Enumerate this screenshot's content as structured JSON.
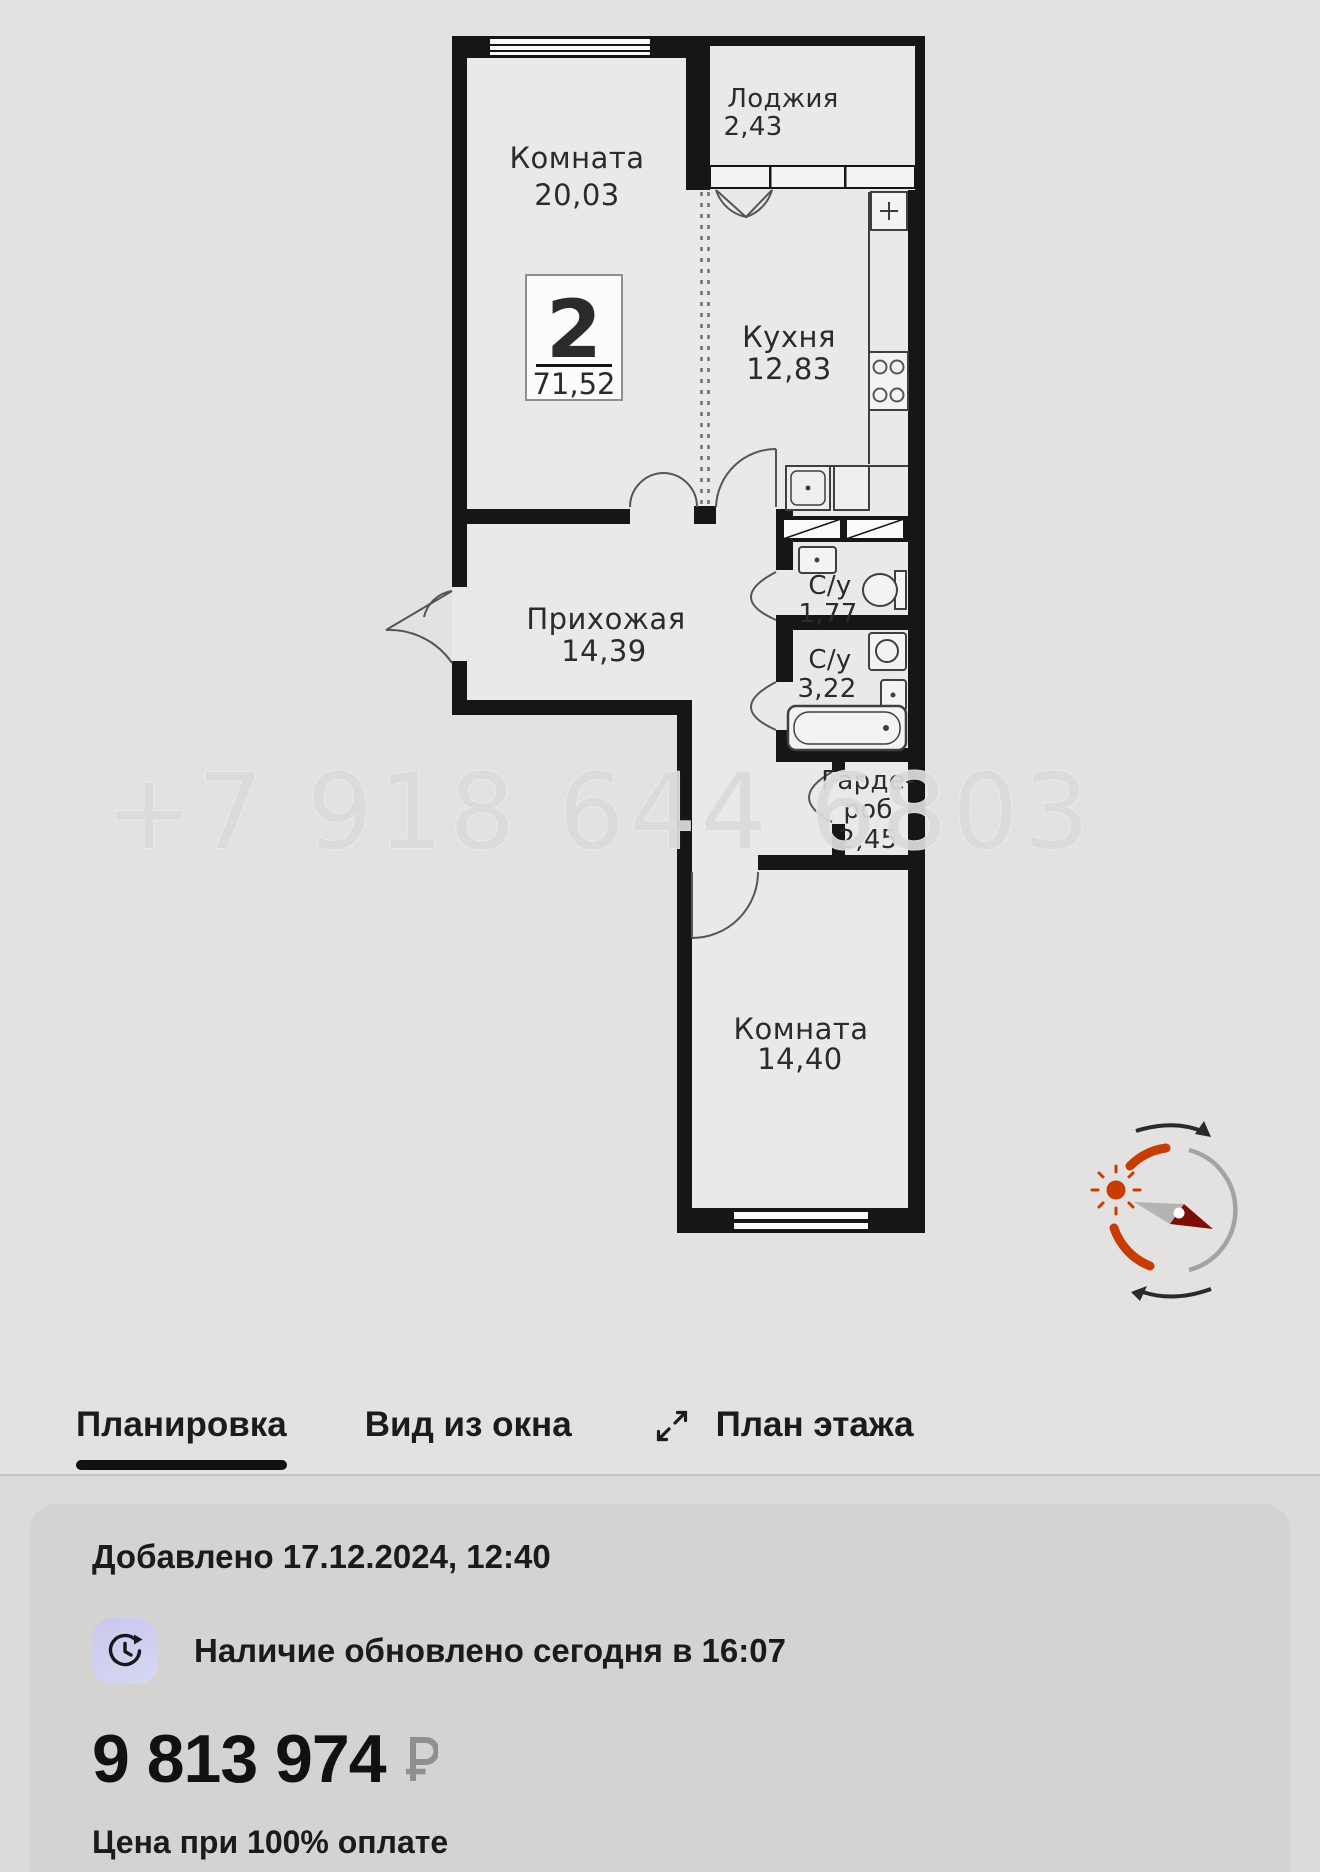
{
  "floorplan": {
    "watermark_phone": "+7 918 644 6803",
    "badge": {
      "rooms_count": "2",
      "total_area": "71,52"
    },
    "rooms": {
      "room1": {
        "name": "Комната",
        "area": "20,03"
      },
      "loggia": {
        "name": "Лоджия",
        "area": "2,43"
      },
      "kitchen": {
        "name": "Кухня",
        "area": "12,83"
      },
      "hallway": {
        "name": "Прихожая",
        "area": "14,39"
      },
      "bathroom1": {
        "name": "С/у",
        "area": "1,77"
      },
      "bathroom2": {
        "name": "С/у",
        "area": "3,22"
      },
      "wardrobe": {
        "name_line1": "Гарде-",
        "name_line2": "роб",
        "area": "2,45"
      },
      "room2": {
        "name": "Комната",
        "area": "14,40"
      }
    }
  },
  "tabs": {
    "layout": "Планировка",
    "window_view": "Вид из окна",
    "floor_plan": "План этажа"
  },
  "listing": {
    "added": "Добавлено 17.12.2024, 12:40",
    "availability": "Наличие обновлено сегодня в 16:07",
    "price": "9 813 974",
    "currency": "₽",
    "price_note": "Цена при 100% оплате"
  },
  "icons": {
    "expand": "expand-arrows",
    "availability": "clock-refresh",
    "compass": "sun-compass",
    "currency": "ruble-sign"
  },
  "colors": {
    "accent_orange": "#c83c02",
    "needle_red": "#7e0d08",
    "wall": "#161616",
    "icon_lavender": "#cbc7ee"
  }
}
